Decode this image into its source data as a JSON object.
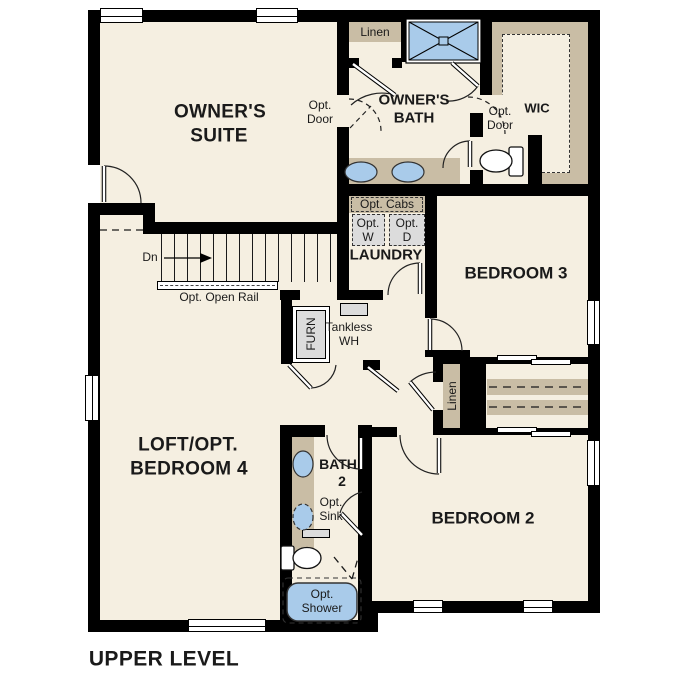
{
  "page_title": "UPPER LEVEL",
  "colors": {
    "floor": "#f5efe1",
    "tan": "#c9bda5",
    "fixture_blue": "#a9cbea",
    "appliance_gray": "#dcdcdc",
    "wall": "#000000",
    "text": "#1a1a1a"
  },
  "rooms": {
    "owners_suite": {
      "line1": "OWNER'S",
      "line2": "SUITE"
    },
    "owners_bath": {
      "line1": "OWNER'S",
      "line2": "BATH"
    },
    "wic": {
      "label": "WIC"
    },
    "laundry": {
      "label": "LAUNDRY"
    },
    "bedroom3": {
      "label": "BEDROOM 3"
    },
    "bedroom2": {
      "label": "BEDROOM 2"
    },
    "loft": {
      "line1": "LOFT/OPT.",
      "line2": "BEDROOM 4"
    },
    "bath2": {
      "line1": "BATH",
      "line2": "2"
    }
  },
  "annotations": {
    "linen_top": "Linen",
    "linen_hall": "Linen",
    "opt_door": {
      "line1": "Opt.",
      "line2": "Door"
    },
    "opt_cabs": "Opt. Cabs",
    "opt_washer": {
      "line1": "Opt.",
      "line2": "W"
    },
    "opt_dryer": {
      "line1": "Opt.",
      "line2": "D"
    },
    "stairs_down": "Dn",
    "opt_open_rail": "Opt. Open Rail",
    "furnace": "FURN",
    "tankless_wh": {
      "line1": "Tankless",
      "line2": "WH"
    },
    "opt_sink": {
      "line1": "Opt.",
      "line2": "Sink"
    },
    "opt_shower": {
      "line1": "Opt.",
      "line2": "Shower"
    }
  }
}
